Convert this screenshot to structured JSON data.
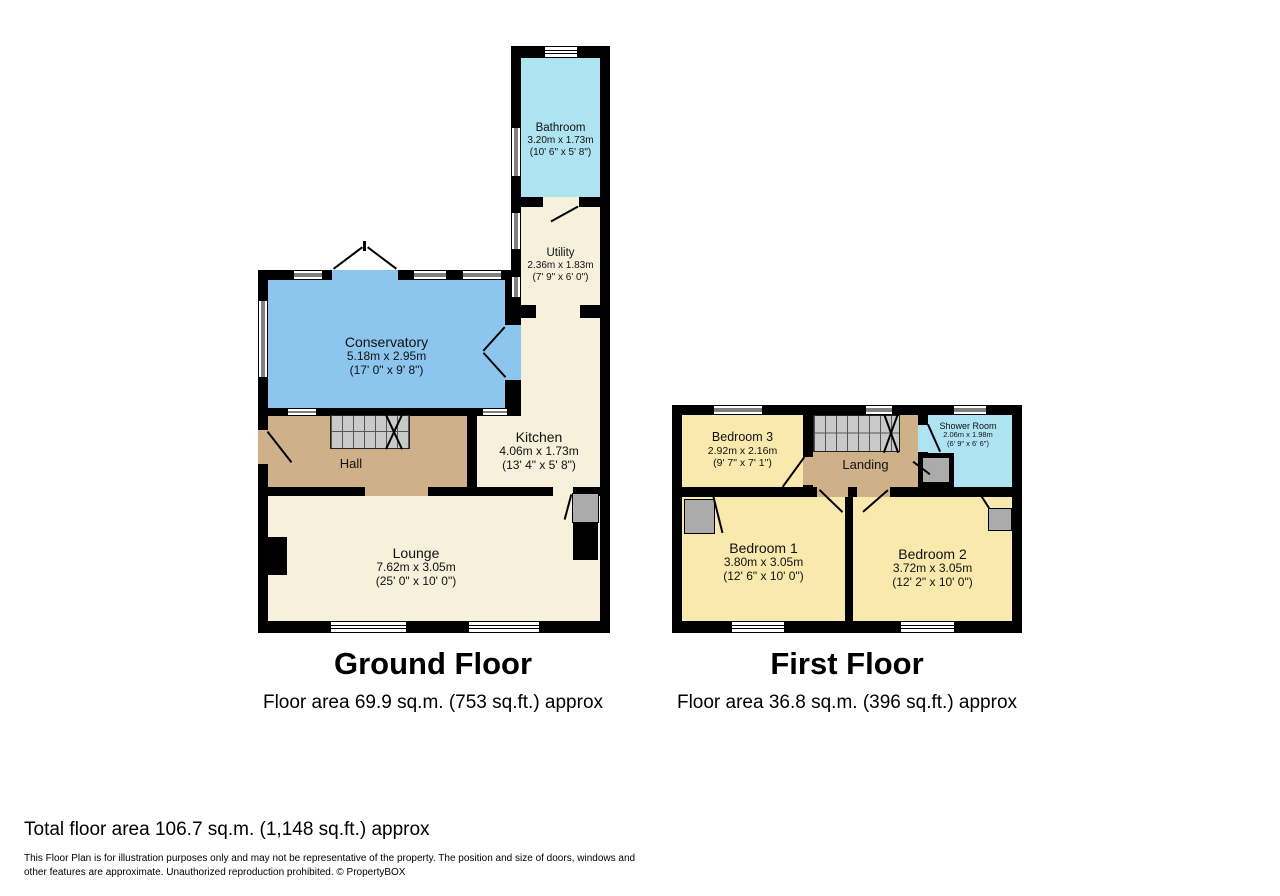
{
  "ground_floor": {
    "title": "Ground Floor",
    "area": "Floor area 69.9 sq.m. (753 sq.ft.) approx",
    "bathroom": {
      "name": "Bathroom",
      "m": "3.20m x 1.73m",
      "ft": "(10' 6\" x 5' 8\")"
    },
    "utility": {
      "name": "Utility",
      "m": "2.36m x 1.83m",
      "ft": "(7' 9\" x 6' 0\")"
    },
    "conservatory": {
      "name": "Conservatory",
      "m": "5.18m x 2.95m",
      "ft": "(17' 0\" x 9' 8\")"
    },
    "kitchen": {
      "name": "Kitchen",
      "m": "4.06m x 1.73m",
      "ft": "(13' 4\" x 5' 8\")"
    },
    "hall": {
      "name": "Hall"
    },
    "lounge": {
      "name": "Lounge",
      "m": "7.62m x 3.05m",
      "ft": "(25' 0\" x 10' 0\")"
    }
  },
  "first_floor": {
    "title": "First Floor",
    "area": "Floor area 36.8 sq.m. (396 sq.ft.) approx",
    "bedroom3": {
      "name": "Bedroom 3",
      "m": "2.92m x 2.16m",
      "ft": "(9' 7\" x 7' 1\")"
    },
    "landing": {
      "name": "Landing"
    },
    "shower": {
      "name": "Shower Room",
      "m": "2.06m x 1.98m",
      "ft": "(6' 9\" x 6' 6\")"
    },
    "bedroom1": {
      "name": "Bedroom 1",
      "m": "3.80m x 3.05m",
      "ft": "(12' 6\" x 10' 0\")"
    },
    "bedroom2": {
      "name": "Bedroom 2",
      "m": "3.72m x 3.05m",
      "ft": "(12' 2\" x 10' 0\")"
    }
  },
  "footer": {
    "total": "Total floor area 106.7 sq.m. (1,148 sq.ft.) approx",
    "disclaimer": "This Floor Plan is for illustration purposes only and may not be representative of the property. The position and size of doors, windows and other features are approximate. Unauthorized reproduction prohibited. © PropertyBOX"
  },
  "colors": {
    "wall": "#000000",
    "cream": "#f7f0da",
    "tan": "#cfb189",
    "blue": "#8cc5ee",
    "cyan": "#aee4f2",
    "yellow": "#f9e9ad",
    "stair": "#c9c9c9",
    "wardrobe": "#ababab"
  }
}
